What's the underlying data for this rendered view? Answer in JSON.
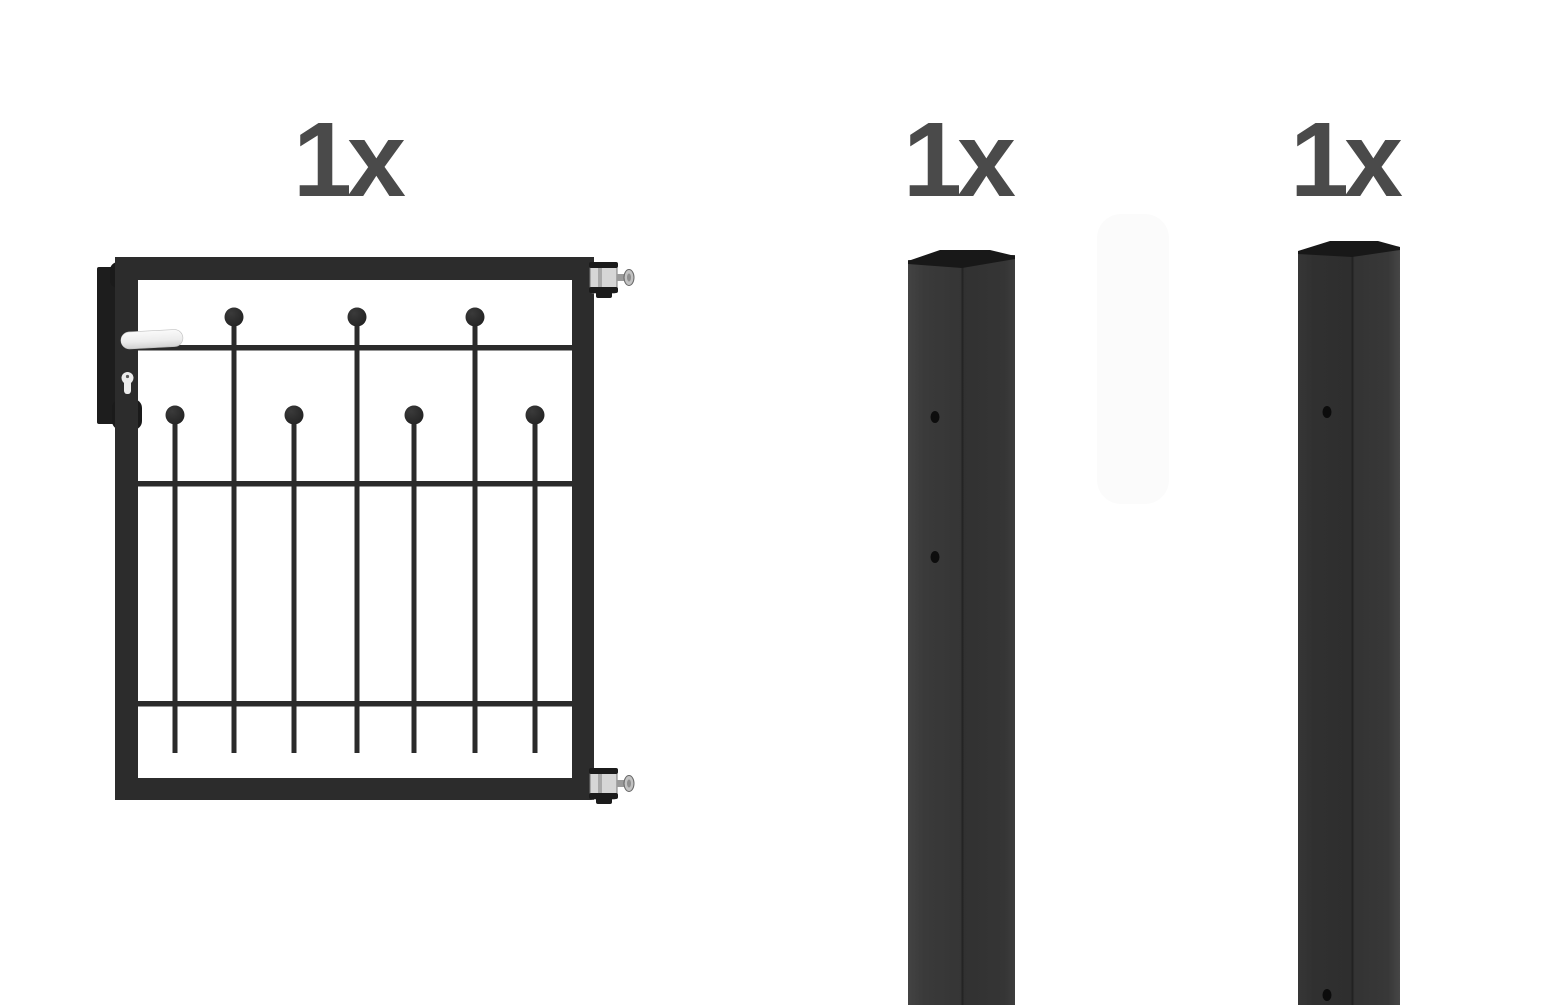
{
  "kit": {
    "items": [
      {
        "name": "garden-gate-leaf",
        "quantity_label": "1x"
      },
      {
        "name": "square-post-two-holes",
        "quantity_label": "1x",
        "holes": 2
      },
      {
        "name": "square-post-one-hole",
        "quantity_label": "1x",
        "holes": 1
      }
    ],
    "colors": {
      "label_text": "#4a4a4a",
      "gate_frame": "#2c2c2c",
      "bar": "#2b2b2b",
      "lock_plate": "#1d1d1d",
      "post_face_light": "#3a3a3a",
      "post_face_dark": "#303030",
      "post_cap": "#181818",
      "hinge_metal": "#d6d6d6",
      "handle_white": "#f5f5f5",
      "background": "#ffffff"
    }
  }
}
